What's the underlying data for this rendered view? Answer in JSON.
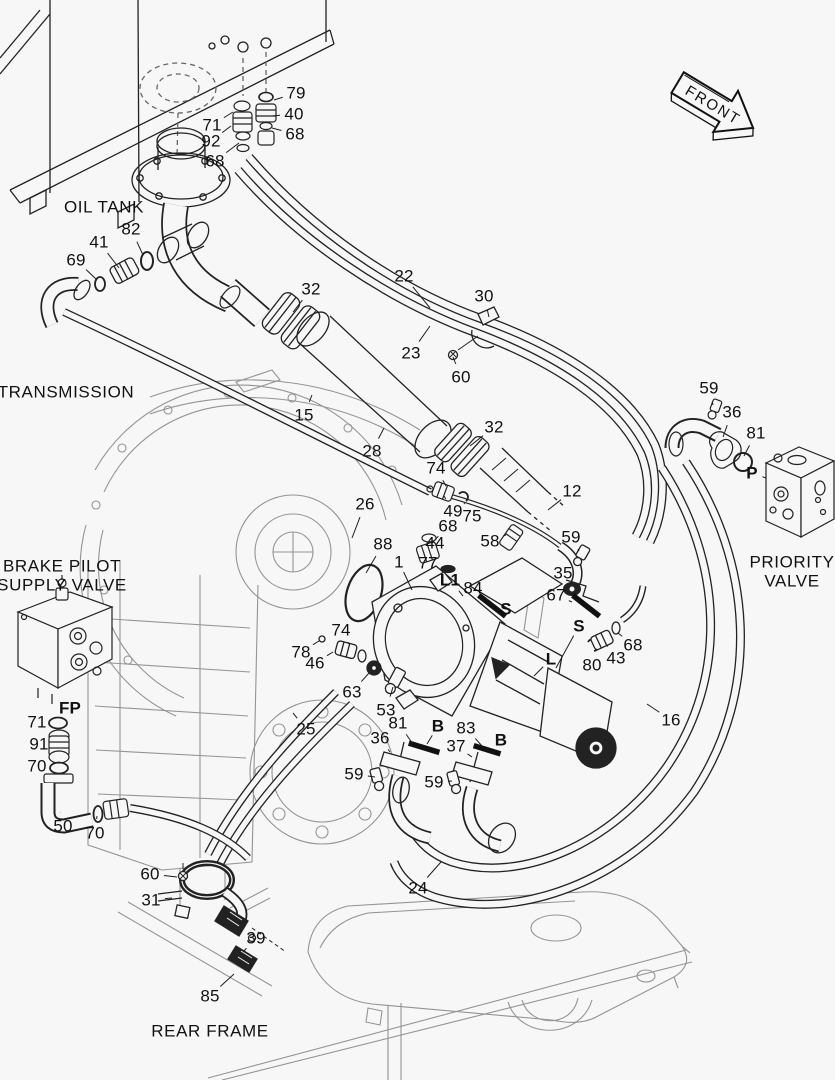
{
  "canvas": {
    "width": 835,
    "height": 1080,
    "background": "#f7f7f7",
    "line_color": "#1e1e1e",
    "light_line_color": "#949494",
    "label_color": "#111111"
  },
  "front_arrow": {
    "label": "FRONT"
  },
  "section_labels": [
    {
      "id": "oil-tank",
      "text": "OIL TANK",
      "x": 104,
      "y": 207
    },
    {
      "id": "transmission",
      "text": "TRANSMISSION",
      "x": 66,
      "y": 392
    },
    {
      "id": "brake-pilot-1",
      "text": "BRAKE PILOT",
      "x": 62,
      "y": 566
    },
    {
      "id": "brake-pilot-2",
      "text": "SUPPLY VALVE",
      "x": 62,
      "y": 585
    },
    {
      "id": "priority-1",
      "text": "PRIORITY",
      "x": 792,
      "y": 562
    },
    {
      "id": "priority-2",
      "text": "VALVE",
      "x": 792,
      "y": 581
    },
    {
      "id": "rear-frame",
      "text": "REAR FRAME",
      "x": 210,
      "y": 1031
    }
  ],
  "part_labels": [
    {
      "text": "79",
      "x": 296,
      "y": 93,
      "leader": [
        274,
        100
      ]
    },
    {
      "text": "40",
      "x": 294,
      "y": 114,
      "leader": [
        272,
        116
      ]
    },
    {
      "text": "68",
      "x": 295,
      "y": 134,
      "leader": [
        272,
        128
      ]
    },
    {
      "text": "71",
      "x": 212,
      "y": 125,
      "leader": [
        233,
        112
      ]
    },
    {
      "text": "92",
      "x": 211,
      "y": 141,
      "leader": [
        231,
        126
      ]
    },
    {
      "text": "68",
      "x": 215,
      "y": 161,
      "leader": [
        239,
        143
      ]
    },
    {
      "text": "82",
      "x": 131,
      "y": 229,
      "leader": [
        143,
        255
      ]
    },
    {
      "text": "41",
      "x": 99,
      "y": 242,
      "leader": [
        119,
        268
      ]
    },
    {
      "text": "69",
      "x": 76,
      "y": 260,
      "leader": [
        97,
        280
      ]
    },
    {
      "text": "22",
      "x": 404,
      "y": 276,
      "leader": [
        430,
        308
      ]
    },
    {
      "text": "23",
      "x": 411,
      "y": 353,
      "leader": [
        430,
        326
      ]
    },
    {
      "text": "30",
      "x": 484,
      "y": 296,
      "leader": [
        489,
        317
      ]
    },
    {
      "text": "60",
      "x": 461,
      "y": 377,
      "leader": [
        453,
        357
      ]
    },
    {
      "text": "32",
      "x": 311,
      "y": 289,
      "leader": [
        293,
        312
      ]
    },
    {
      "text": "32",
      "x": 494,
      "y": 427,
      "leader": [
        470,
        446
      ]
    },
    {
      "text": "15",
      "x": 304,
      "y": 415,
      "leader": [
        312,
        395
      ]
    },
    {
      "text": "28",
      "x": 372,
      "y": 451,
      "leader": [
        384,
        428
      ]
    },
    {
      "text": "74",
      "x": 436,
      "y": 468,
      "leader": [
        446,
        486
      ]
    },
    {
      "text": "49",
      "x": 453,
      "y": 511,
      "leader": [
        444,
        496
      ]
    },
    {
      "text": "75",
      "x": 472,
      "y": 516,
      "leader": [
        464,
        503
      ]
    },
    {
      "text": "12",
      "x": 572,
      "y": 491,
      "leader": [
        548,
        510
      ]
    },
    {
      "text": "26",
      "x": 365,
      "y": 504,
      "leader": [
        352,
        538
      ]
    },
    {
      "text": "88",
      "x": 383,
      "y": 544,
      "leader": [
        366,
        573
      ]
    },
    {
      "text": "68",
      "x": 448,
      "y": 526,
      "leader": [
        432,
        543
      ]
    },
    {
      "text": "44",
      "x": 435,
      "y": 543,
      "leader": [
        424,
        552
      ]
    },
    {
      "text": "58",
      "x": 490,
      "y": 541,
      "leader": [
        506,
        535
      ]
    },
    {
      "text": "77",
      "x": 428,
      "y": 563,
      "leader": [
        444,
        568
      ]
    },
    {
      "text": "1",
      "x": 399,
      "y": 562,
      "leader": [
        412,
        590
      ]
    },
    {
      "text": "L1",
      "x": 450,
      "y": 580,
      "bold": true,
      "leader": [
        463,
        596
      ]
    },
    {
      "text": "84",
      "x": 473,
      "y": 588,
      "leader": [
        488,
        600
      ]
    },
    {
      "text": "S",
      "x": 506,
      "y": 609,
      "bold": true
    },
    {
      "text": "59",
      "x": 571,
      "y": 537,
      "leader": [
        579,
        551
      ]
    },
    {
      "text": "35",
      "x": 563,
      "y": 573,
      "leader": [
        575,
        583
      ]
    },
    {
      "text": "67",
      "x": 556,
      "y": 595,
      "leader": [
        572,
        602
      ]
    },
    {
      "text": "59",
      "x": 709,
      "y": 388,
      "leader": [
        713,
        405
      ]
    },
    {
      "text": "36",
      "x": 732,
      "y": 412,
      "leader": [
        723,
        437
      ]
    },
    {
      "text": "81",
      "x": 756,
      "y": 433,
      "leader": [
        744,
        456
      ]
    },
    {
      "text": "P",
      "x": 752,
      "y": 473,
      "bold": true,
      "leader": [
        766,
        478
      ]
    },
    {
      "text": "S",
      "x": 579,
      "y": 626,
      "bold": true,
      "leader": [
        556,
        668
      ]
    },
    {
      "text": "L",
      "x": 551,
      "y": 659,
      "bold": true,
      "leader": [
        534,
        676
      ]
    },
    {
      "text": "80",
      "x": 592,
      "y": 665,
      "leader": [
        592,
        651
      ]
    },
    {
      "text": "43",
      "x": 616,
      "y": 658,
      "leader": [
        606,
        644
      ]
    },
    {
      "text": "68",
      "x": 633,
      "y": 645,
      "leader": [
        618,
        633
      ]
    },
    {
      "text": "16",
      "x": 671,
      "y": 720,
      "leader": [
        647,
        704
      ]
    },
    {
      "text": "74",
      "x": 341,
      "y": 630,
      "leader": [
        349,
        644
      ]
    },
    {
      "text": "78",
      "x": 301,
      "y": 652,
      "leader": [
        319,
        641
      ]
    },
    {
      "text": "46",
      "x": 315,
      "y": 663,
      "leader": [
        333,
        652
      ]
    },
    {
      "text": "63",
      "x": 352,
      "y": 692,
      "leader": [
        369,
        673
      ]
    },
    {
      "text": "53",
      "x": 386,
      "y": 710,
      "leader": [
        393,
        687
      ]
    },
    {
      "text": "25",
      "x": 306,
      "y": 729,
      "leader": [
        293,
        713
      ]
    },
    {
      "text": "81",
      "x": 398,
      "y": 723,
      "leader": [
        413,
        744
      ]
    },
    {
      "text": "36",
      "x": 380,
      "y": 738,
      "leader": [
        390,
        752
      ]
    },
    {
      "text": "B",
      "x": 438,
      "y": 726,
      "bold": true,
      "leader": [
        427,
        744
      ]
    },
    {
      "text": "83",
      "x": 466,
      "y": 728,
      "leader": [
        482,
        746
      ]
    },
    {
      "text": "B",
      "x": 501,
      "y": 740,
      "bold": true
    },
    {
      "text": "37",
      "x": 456,
      "y": 746,
      "leader": [
        472,
        757
      ]
    },
    {
      "text": "59",
      "x": 354,
      "y": 774,
      "leader": [
        375,
        777
      ]
    },
    {
      "text": "59",
      "x": 434,
      "y": 782,
      "leader": [
        452,
        781
      ]
    },
    {
      "text": "FP",
      "x": 70,
      "y": 708,
      "bold": true,
      "leader": [
        62,
        719
      ]
    },
    {
      "text": "71",
      "x": 37,
      "y": 722,
      "leader": [
        50,
        722
      ]
    },
    {
      "text": "91",
      "x": 39,
      "y": 744,
      "leader": [
        50,
        744
      ]
    },
    {
      "text": "70",
      "x": 37,
      "y": 766,
      "leader": [
        50,
        765
      ]
    },
    {
      "text": "50",
      "x": 63,
      "y": 826,
      "leader": [
        60,
        812
      ]
    },
    {
      "text": "70",
      "x": 95,
      "y": 833,
      "leader": [
        97,
        816
      ]
    },
    {
      "text": "60",
      "x": 150,
      "y": 874,
      "leader": [
        177,
        877
      ]
    },
    {
      "text": "31",
      "x": 151,
      "y": 900,
      "leader": [
        172,
        898
      ]
    },
    {
      "text": "39",
      "x": 256,
      "y": 938,
      "leader": [
        243,
        952
      ]
    },
    {
      "text": "24",
      "x": 418,
      "y": 888,
      "leader": [
        441,
        862
      ]
    },
    {
      "text": "85",
      "x": 210,
      "y": 996,
      "leader": [
        234,
        974
      ]
    }
  ]
}
